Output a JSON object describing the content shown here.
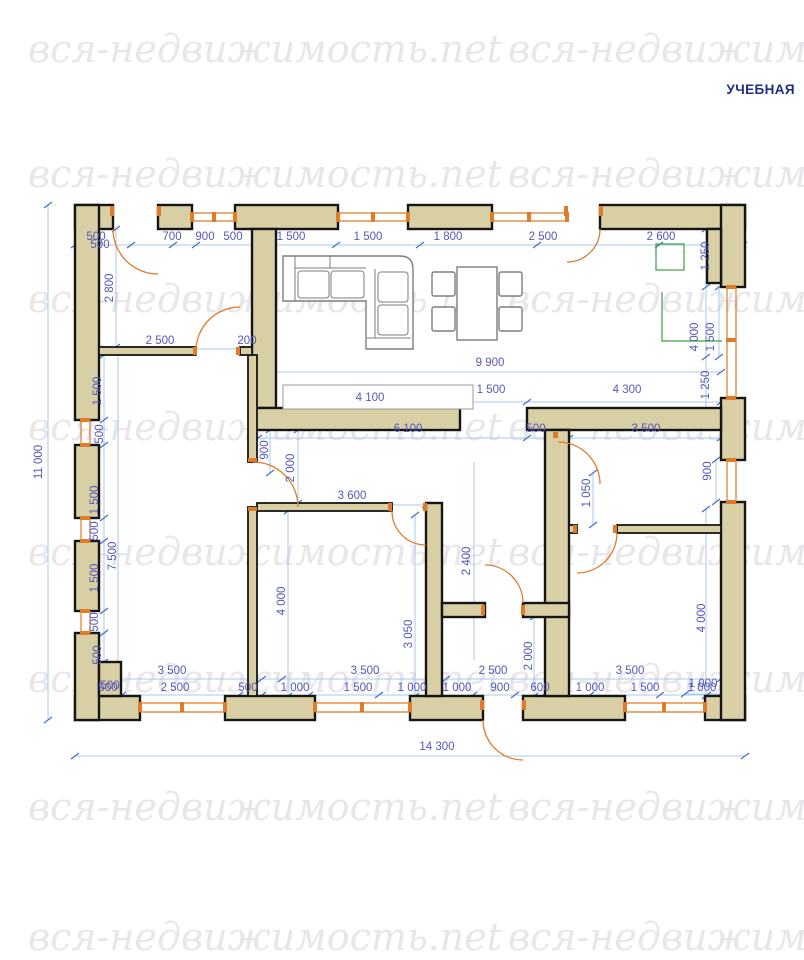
{
  "header": {
    "training_label": "УЧЕБНАЯ"
  },
  "watermark": {
    "text": "вся-недвижимость.net"
  },
  "colors": {
    "wall_fill": "#d9cfa5",
    "wall_stroke": "#151515",
    "dimension_text": "#5558bb",
    "dimension_line": "#aac9e9",
    "tick": "#4d74cc",
    "door_window_orange": "#e07b28",
    "kitchen_green": "#3da23d",
    "furniture_gray": "#7d7d7d",
    "watermark_gray": "#e7e7eb",
    "badge_navy": "#1e2f86"
  },
  "plan": {
    "overall_width": "14 300",
    "overall_height": "11 000",
    "units": "mm"
  },
  "dimensions_mm": [
    {
      "t": "500",
      "x": 96,
      "y": 240,
      "r": 0
    },
    {
      "t": "700",
      "x": 172,
      "y": 240,
      "r": 0
    },
    {
      "t": "900",
      "x": 205,
      "y": 240,
      "r": 0
    },
    {
      "t": "500",
      "x": 233,
      "y": 240,
      "r": 0
    },
    {
      "t": "1 500",
      "x": 291,
      "y": 240,
      "r": 0
    },
    {
      "t": "1 500",
      "x": 368,
      "y": 240,
      "r": 0
    },
    {
      "t": "1 800",
      "x": 448,
      "y": 240,
      "r": 0
    },
    {
      "t": "2 500",
      "x": 543,
      "y": 240,
      "r": 0
    },
    {
      "t": "2 600",
      "x": 661,
      "y": 240,
      "r": 0
    },
    {
      "t": "1 250",
      "x": 709,
      "y": 256,
      "r": 1
    },
    {
      "t": "4 000",
      "x": 698,
      "y": 337,
      "r": 1
    },
    {
      "t": "1 500",
      "x": 714,
      "y": 337,
      "r": 1
    },
    {
      "t": "1 250",
      "x": 709,
      "y": 385,
      "r": 1
    },
    {
      "t": "900",
      "x": 711,
      "y": 471,
      "r": 1
    },
    {
      "t": "4 000",
      "x": 705,
      "y": 618,
      "r": 1
    },
    {
      "t": "1 000",
      "x": 703,
      "y": 687,
      "r": 0
    },
    {
      "t": "11 000",
      "x": 42,
      "y": 462,
      "r": 1
    },
    {
      "t": "500",
      "x": 100,
      "y": 248,
      "r": 0
    },
    {
      "t": "2 800",
      "x": 113,
      "y": 288,
      "r": 1
    },
    {
      "t": "1 500",
      "x": 101,
      "y": 391,
      "r": 1
    },
    {
      "t": "500",
      "x": 103,
      "y": 434,
      "r": 1
    },
    {
      "t": "1 500",
      "x": 98,
      "y": 500,
      "r": 1
    },
    {
      "t": "500",
      "x": 98,
      "y": 531,
      "r": 1
    },
    {
      "t": "1 500",
      "x": 98,
      "y": 578,
      "r": 1
    },
    {
      "t": "500",
      "x": 98,
      "y": 622,
      "r": 1
    },
    {
      "t": "500",
      "x": 101,
      "y": 655,
      "r": 1
    },
    {
      "t": "500",
      "x": 110,
      "y": 689,
      "r": 0
    },
    {
      "t": "7 500",
      "x": 116,
      "y": 556,
      "r": 1
    },
    {
      "t": "3 500",
      "x": 172,
      "y": 674,
      "r": 0
    },
    {
      "t": "3 500",
      "x": 365,
      "y": 674,
      "r": 0
    },
    {
      "t": "2 500",
      "x": 493,
      "y": 674,
      "r": 0
    },
    {
      "t": "3 500",
      "x": 630,
      "y": 674,
      "r": 0
    },
    {
      "t": "500",
      "x": 108,
      "y": 691,
      "r": 0
    },
    {
      "t": "2 500",
      "x": 175,
      "y": 691,
      "r": 0
    },
    {
      "t": "500",
      "x": 248,
      "y": 691,
      "r": 0
    },
    {
      "t": "1 000",
      "x": 295,
      "y": 691,
      "r": 0
    },
    {
      "t": "1 500",
      "x": 358,
      "y": 691,
      "r": 0
    },
    {
      "t": "1 000",
      "x": 412,
      "y": 691,
      "r": 0
    },
    {
      "t": "1 000",
      "x": 457,
      "y": 691,
      "r": 0
    },
    {
      "t": "900",
      "x": 500,
      "y": 691,
      "r": 0
    },
    {
      "t": "600",
      "x": 540,
      "y": 691,
      "r": 0
    },
    {
      "t": "1 000",
      "x": 590,
      "y": 691,
      "r": 0
    },
    {
      "t": "1 500",
      "x": 645,
      "y": 691,
      "r": 0
    },
    {
      "t": "1 000",
      "x": 702,
      "y": 691,
      "r": 0
    },
    {
      "t": "14 300",
      "x": 437,
      "y": 750,
      "r": 0
    },
    {
      "t": "2 500",
      "x": 160,
      "y": 344,
      "r": 0
    },
    {
      "t": "200",
      "x": 247,
      "y": 344,
      "r": 0
    },
    {
      "t": "9 900",
      "x": 490,
      "y": 366,
      "r": 0
    },
    {
      "t": "4 100",
      "x": 370,
      "y": 401,
      "r": 0
    },
    {
      "t": "1 500",
      "x": 491,
      "y": 393,
      "r": 0
    },
    {
      "t": "4 300",
      "x": 627,
      "y": 393,
      "r": 0
    },
    {
      "t": "6 100",
      "x": 408,
      "y": 432,
      "r": 0
    },
    {
      "t": "500",
      "x": 536,
      "y": 432,
      "r": 0
    },
    {
      "t": "3 500",
      "x": 646,
      "y": 432,
      "r": 0
    },
    {
      "t": "900",
      "x": 268,
      "y": 450,
      "r": 1
    },
    {
      "t": "2 000",
      "x": 294,
      "y": 468,
      "r": 1
    },
    {
      "t": "3 600",
      "x": 352,
      "y": 499,
      "r": 0
    },
    {
      "t": "1 050",
      "x": 590,
      "y": 493,
      "r": 1
    },
    {
      "t": "2 400",
      "x": 470,
      "y": 561,
      "r": 1
    },
    {
      "t": "4 000",
      "x": 285,
      "y": 601,
      "r": 1
    },
    {
      "t": "3 050",
      "x": 412,
      "y": 634,
      "r": 1
    },
    {
      "t": "2 000",
      "x": 532,
      "y": 656,
      "r": 1
    }
  ]
}
